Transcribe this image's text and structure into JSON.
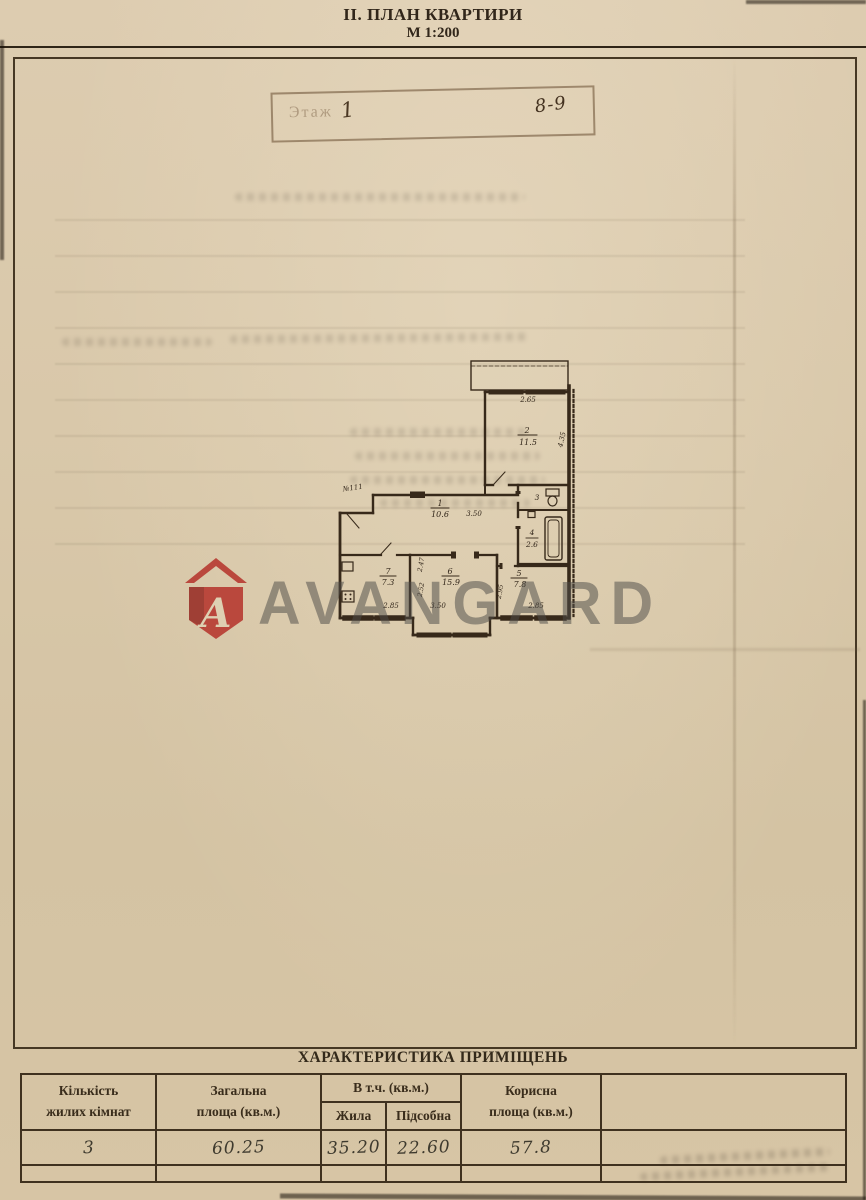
{
  "header": {
    "title": "ІІ. ПЛАН КВАРТИРИ",
    "scale": "М 1:200"
  },
  "stamp": {
    "printed_label": "Этаж",
    "floor": "1",
    "flat_range": "8-9"
  },
  "watermark": {
    "brand": "AVANGARD",
    "logo_letter": "A",
    "red": "#b5322a"
  },
  "plan": {
    "entrance_label": "№111",
    "rooms": {
      "corridor": {
        "num": "1",
        "area": "10.6"
      },
      "bedroom_top": {
        "num": "2",
        "area": "11.5"
      },
      "wc": {
        "num": "3"
      },
      "bath": {
        "num": "4",
        "area": "2.6"
      },
      "bedroom_right": {
        "num": "5",
        "area": "7.8"
      },
      "living": {
        "num": "6",
        "area": "15.9"
      },
      "kitchen": {
        "num": "7",
        "area": "7.3"
      }
    },
    "dims": {
      "top_width": "2.65",
      "room2_depth": "4.35",
      "corridor_len": "3.50",
      "kitchen_width": "2.85",
      "kitchen_depth_a": "2.47",
      "kitchen_depth_b": "2.52",
      "room6_width": "3.50",
      "room5_width": "2.85",
      "room5_depth": "2.95"
    }
  },
  "table": {
    "title": "ХАРАКТЕРИСТИКА ПРИМІЩЕНЬ",
    "col_rooms_l1": "Кількість",
    "col_rooms_l2": "жилих кімнат",
    "col_total_l1": "Загальна",
    "col_total_l2": "площа (кв.м.)",
    "col_incl": "В т.ч. (кв.м.)",
    "col_living": "Жила",
    "col_aux": "Підсобна",
    "col_useful_l1": "Корисна",
    "col_useful_l2": "площа (кв.м.)",
    "values": {
      "rooms": "3",
      "total": "60.25",
      "living": "35.20",
      "aux": "22.60",
      "useful": "57.8"
    }
  }
}
